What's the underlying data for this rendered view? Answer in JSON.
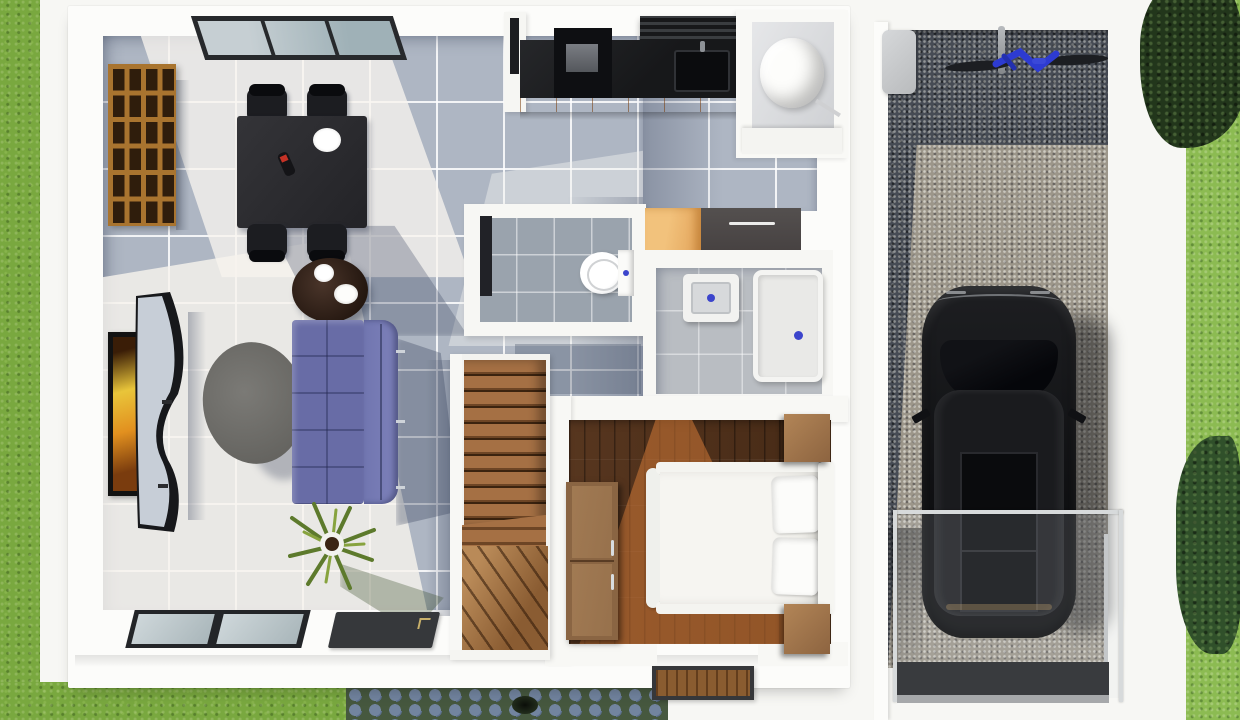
{
  "scene": {
    "title": "Top-down 3D floor plan render of a small house with single-car gravel garage",
    "view": "top-down",
    "style": "3D architectural visualization, no text labels"
  },
  "palette": {
    "grass": "#79a83f",
    "grass_bright": "#8cbb52",
    "tree_dark": "#22361b",
    "tile_floor": "#aeb6c3",
    "wall_white": "#f8f8f5",
    "wood_floor_dark": "#4e311d",
    "wood_floor_sunlit": "#c87c3f",
    "stair_wood": "#a57044",
    "shelf_wood": "#a9742f",
    "kitchen_counter": "#17181a",
    "cabinet_orange": "#d9953f",
    "wardrobe_orange": "#e2a258",
    "wardrobe_dark": "#443f3f",
    "nightstand_wood": "#b28557",
    "sofa_purple": "#686ca6",
    "gravel_dark": "#474c55",
    "gravel_sunlit": "#9c968a",
    "car_black": "#141517",
    "ramp_dark": "#393b3e",
    "accent_blue_fixtures": "#3c45cc",
    "accent_red": "#c53226",
    "bicycle_blue": "#2d3bd1",
    "cobblestone_blue": "#72849f"
  },
  "rooms": {
    "living_room": {
      "label": "Living room — grey ceramic tile floor"
    },
    "dining_area": {
      "label": "Dining area"
    },
    "kitchen": {
      "label": "Kitchen"
    },
    "utility_room": {
      "label": "Utility room with water heater"
    },
    "wc": {
      "label": "Toilet room"
    },
    "bathroom": {
      "label": "Bathroom with basin and shower"
    },
    "bedroom": {
      "label": "Bedroom — dark wood plank floor"
    },
    "staircase": {
      "label": "Wooden staircase with winder steps"
    },
    "porch": {
      "label": "Front porch"
    },
    "garage": {
      "label": "Garage with gravel driveway"
    },
    "yard": {
      "label": "Lawn and planted borders"
    }
  },
  "objects": {
    "skylight_window": "Glazed window in top wall",
    "bookshelf": "Wooden cubby bookshelf",
    "dining_table": "Black dining table",
    "dining_chair": "Black dining chair",
    "dining_plate": "White serving plate",
    "wine_bottle": "Bottle with red label",
    "coffee_table_round": "Round dark-wood coffee table with white bowls",
    "tv_console": "Curved silver and black TV console",
    "wall_art": "Framed artwork on living room wall",
    "side_table_oval": "Oval grey side table",
    "sofa": "Purple three-seat sofa with chaise back",
    "house_plant": "Potted spiky house plant",
    "toilet": "Toilet with cistern",
    "wc_door": "Open toilet-room door",
    "bathroom_sink": "Square wash basin with blue tap mark",
    "shower_tray": "Walk-in shower tray with blue drain mark",
    "wardrobe_orange": "Orange wardrobe cabinet",
    "wardrobe_dark": "Dark grey wardrobe cabinet",
    "water_heater": "Cylindrical water heater",
    "kitchen_counter": "Black kitchen counter",
    "cooktop": "Cooktop appliance",
    "kitchen_sink": "Kitchen sink",
    "range_hood": "Range hood with vent slats",
    "kitchen_cabinets": "Orange cabinet fronts",
    "bed": "Double bed with white bedding and two pillows",
    "nightstand": "Wooden nightstand",
    "dresser": "Wooden dresser",
    "bedroom_doormat": "Bedroom entry doormat",
    "entry_glass_door": "Sliding glass entry door",
    "entry_mat": "Dark entry mat",
    "staircase": "Wooden staircase",
    "car": "Black car parked on gravel",
    "bicycle": "Blue bicycle on stand",
    "storage_box": "Grey storage unit",
    "glass_railing": "Frameless glass railing at driveway",
    "driveway_ramp": "Dark driveway ramp with kerb",
    "cobble_path": "Blue cobblestone garden path with drain",
    "tree": "Dark tree canopy",
    "bush": "Garden bush"
  }
}
